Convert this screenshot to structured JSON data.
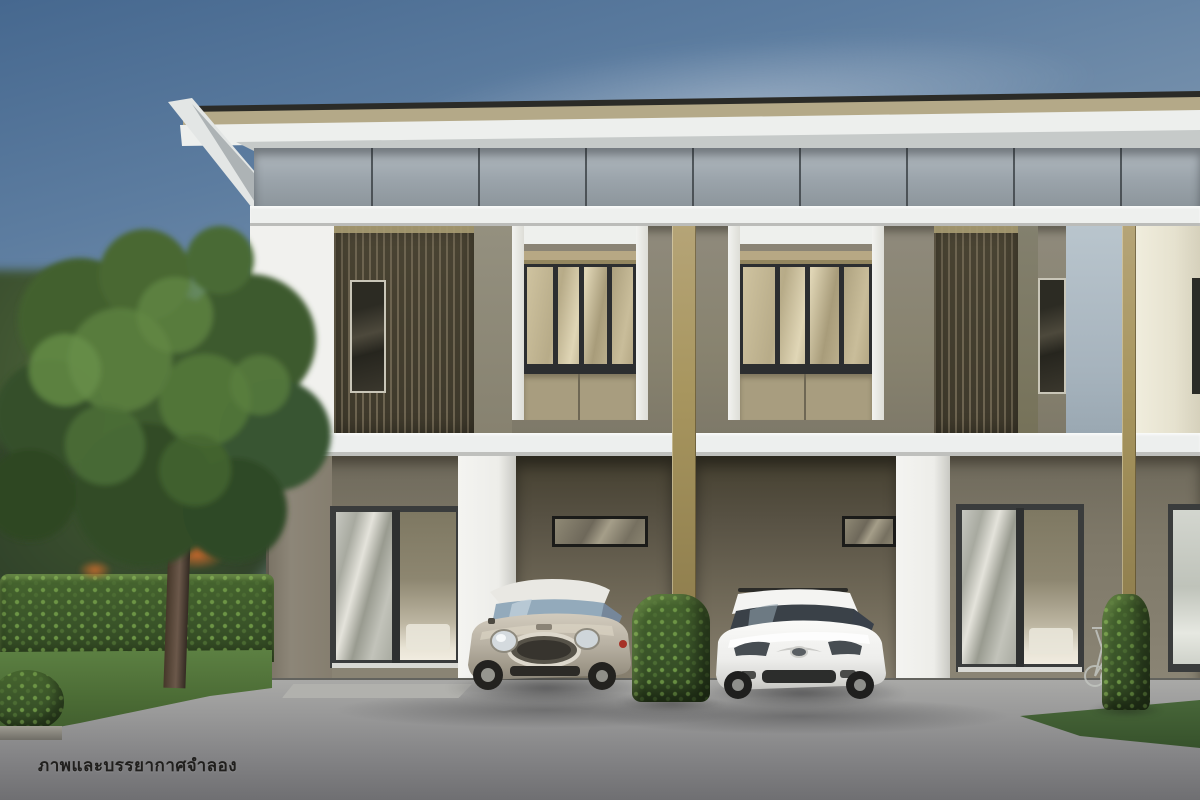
{
  "scene": {
    "type": "3d-architectural-rendering",
    "subject": "modern two-storey townhouse row with recessed carports, two parked cars, garden and driveway",
    "units_visible": 3,
    "vehicles": [
      "silver mini hatchback",
      "white mazda hatchback"
    ],
    "landscape": [
      "large tree",
      "trimmed hedge",
      "lawn",
      "column-shaped shrubs",
      "concrete driveway"
    ]
  },
  "watermark": {
    "text": "ภาพและบรรยากาศจำลอง"
  },
  "palette": {
    "sky_top": "#46688f",
    "sky_horizon": "#c4cacd",
    "roof_edge_dark": "#2b2b27",
    "fascia_beige": "#b4a988",
    "soffit_white": "#edefed",
    "parapet_grey": "#9aa3aa",
    "trim_white": "#eef0ee",
    "wall_taupe_upper": "#8f8a7c",
    "wall_taupe_lower": "#7e7868",
    "louver_slat": "#6d6450",
    "louver_dark": "#3e392b",
    "pillar_beige": "#a8965f",
    "panel_blue_grey": "#aebbc4",
    "panel_cream": "#e9e6d8",
    "window_frame_dark": "#2c2e30",
    "window_glass_warm": "#c3b795",
    "hedge_green": "#3a5429",
    "grass_green": "#4a6a34",
    "driveway_grey": "#8f8f90",
    "car_mini_silver": "#bdb6a9",
    "car_mazda_white": "#f1f1ef"
  }
}
